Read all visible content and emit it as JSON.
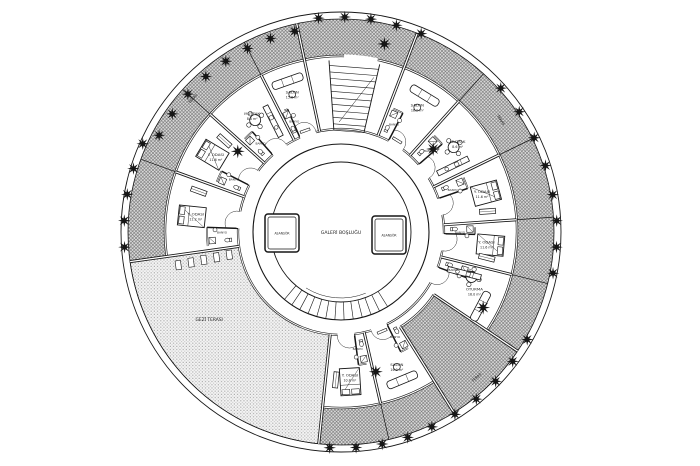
{
  "canvas": {
    "width": 700,
    "height": 466,
    "paper": "#ffffff",
    "ink": "#161616",
    "text_color": "#1c1c1c",
    "band_fill": "#dcdcdc",
    "band_line": "#6b6b6b",
    "dot_light": "#f4f4f4",
    "dot_a": "#a6a6a6",
    "dot_b": "#c9c9c9"
  },
  "geometry": {
    "cx": 341,
    "cy": 232,
    "r_rim_outer": 220,
    "r_rim_inner": 213,
    "r_band_inner": 176,
    "r_unit_inner": 103,
    "r_corridor_inner": 88,
    "r_void": 70,
    "big_sector": [
      96,
      172
    ],
    "stair_hall": [
      258,
      291
    ],
    "terrace_wedge": [
      394,
      418
    ],
    "wedge_inner_r": 112
  },
  "core": {
    "atrium_label": "GALERİ BOŞLUĞU",
    "elevators": [
      {
        "label": "ASANSÖR",
        "x": 282,
        "y": 233,
        "w": 34,
        "h": 38
      },
      {
        "label": "ASANSÖR",
        "x": 389,
        "y": 235,
        "w": 34,
        "h": 38
      }
    ],
    "core_stair": {
      "a0": 58,
      "a1": 132,
      "step": 6
    },
    "top_stair": {
      "a0": 266,
      "a1": 283,
      "r0": 102,
      "r1": 172,
      "step": 6.5
    }
  },
  "terrace": {
    "big_label": "GEZİ TERASI",
    "big_label_angle": 146,
    "big_label_r": 159,
    "ring_labels": [
      {
        "text": "TERAS",
        "angle": 222,
        "r": 198
      },
      {
        "text": "TERAS",
        "angle": 325,
        "r": 194
      },
      {
        "text": "TERAS",
        "angle": 47,
        "r": 200
      }
    ]
  },
  "units": [
    {
      "a0": 172,
      "a1": 200,
      "type": "bedroom",
      "name": "Y. ODASI",
      "area": "11.2 m²",
      "bath": "BANYO"
    },
    {
      "a0": 200,
      "a1": 222,
      "type": "bedroom",
      "name": "Y. ODASI",
      "area": "11.6 m²",
      "bath": "BANYO"
    },
    {
      "a0": 222,
      "a1": 243,
      "type": "dining",
      "name": "MUTFAK",
      "area": "8.6 m²",
      "bath": "BANYO"
    },
    {
      "a0": 243,
      "a1": 258,
      "type": "living",
      "name": "SALON",
      "area": "15.8 m²",
      "bath": "BANYO"
    },
    {
      "a0": 258,
      "a1": 291,
      "type": "stairs",
      "name": "",
      "area": "",
      "bath": ""
    },
    {
      "a0": 291,
      "a1": 312,
      "type": "living",
      "name": "SALON",
      "area": "16.2 m²",
      "bath": "BANYO"
    },
    {
      "a0": 312,
      "a1": 334,
      "type": "dining",
      "name": "MUTFAK",
      "area": "8.6 m²",
      "bath": "BANYO"
    },
    {
      "a0": 334,
      "a1": 356,
      "type": "bedroom",
      "name": "Y. ODASI",
      "area": "11.6 m²",
      "bath": "BANYO"
    },
    {
      "a0": 356,
      "a1": 374,
      "type": "bedroom",
      "name": "Y. ODASI",
      "area": "11.6 m²",
      "bath": "BANYO"
    },
    {
      "a0": 374,
      "a1": 394,
      "type": "livinglong",
      "name": "OTURMA",
      "area": "16.0 m²",
      "bath": "BANYO"
    },
    {
      "a0": 394,
      "a1": 418,
      "type": "wedge",
      "name": "",
      "area": "",
      "bath": ""
    },
    {
      "a0": 418,
      "a1": 437,
      "type": "living",
      "name": "SALON",
      "area": "16.0 m²",
      "bath": "BANYO"
    },
    {
      "a0": 437,
      "a1": 456,
      "type": "bedroom",
      "name": "Y. ODASI",
      "area": "10.8 m²",
      "bath": "BANYO"
    }
  ],
  "trees": {
    "rim": [
      {
        "a": 176,
        "r": 217
      },
      {
        "a": 183,
        "r": 217
      },
      {
        "a": 190,
        "r": 217
      },
      {
        "a": 197,
        "r": 217
      },
      {
        "a": 204,
        "r": 217
      },
      {
        "a": 208,
        "r": 206
      },
      {
        "a": 215,
        "r": 206
      },
      {
        "a": 222,
        "r": 206
      },
      {
        "a": 229,
        "r": 206
      },
      {
        "a": 236,
        "r": 206
      },
      {
        "a": 243,
        "r": 206
      },
      {
        "a": 250,
        "r": 206
      },
      {
        "a": 257,
        "r": 206
      },
      {
        "a": 264,
        "r": 215
      },
      {
        "a": 271,
        "r": 215
      },
      {
        "a": 278,
        "r": 215
      },
      {
        "a": 285,
        "r": 214
      },
      {
        "a": 292,
        "r": 214
      },
      {
        "a": 318,
        "r": 215
      },
      {
        "a": 326,
        "r": 215
      },
      {
        "a": 334,
        "r": 215
      },
      {
        "a": 342,
        "r": 215
      },
      {
        "a": 350,
        "r": 215
      },
      {
        "a": 357,
        "r": 216
      },
      {
        "a": 4,
        "r": 216
      },
      {
        "a": 11,
        "r": 216
      },
      {
        "a": 30,
        "r": 215
      },
      {
        "a": 37,
        "r": 215
      },
      {
        "a": 44,
        "r": 215
      },
      {
        "a": 51,
        "r": 215
      },
      {
        "a": 58,
        "r": 215
      },
      {
        "a": 65,
        "r": 215
      },
      {
        "a": 72,
        "r": 216
      },
      {
        "a": 79,
        "r": 216
      },
      {
        "a": 86,
        "r": 216
      },
      {
        "a": 93,
        "r": 216
      }
    ],
    "inner": [
      {
        "a": 218,
        "r": 131
      },
      {
        "a": 318,
        "r": 124
      },
      {
        "a": 28,
        "r": 161
      },
      {
        "a": 283,
        "r": 193
      },
      {
        "a": 76,
        "r": 144
      }
    ]
  }
}
